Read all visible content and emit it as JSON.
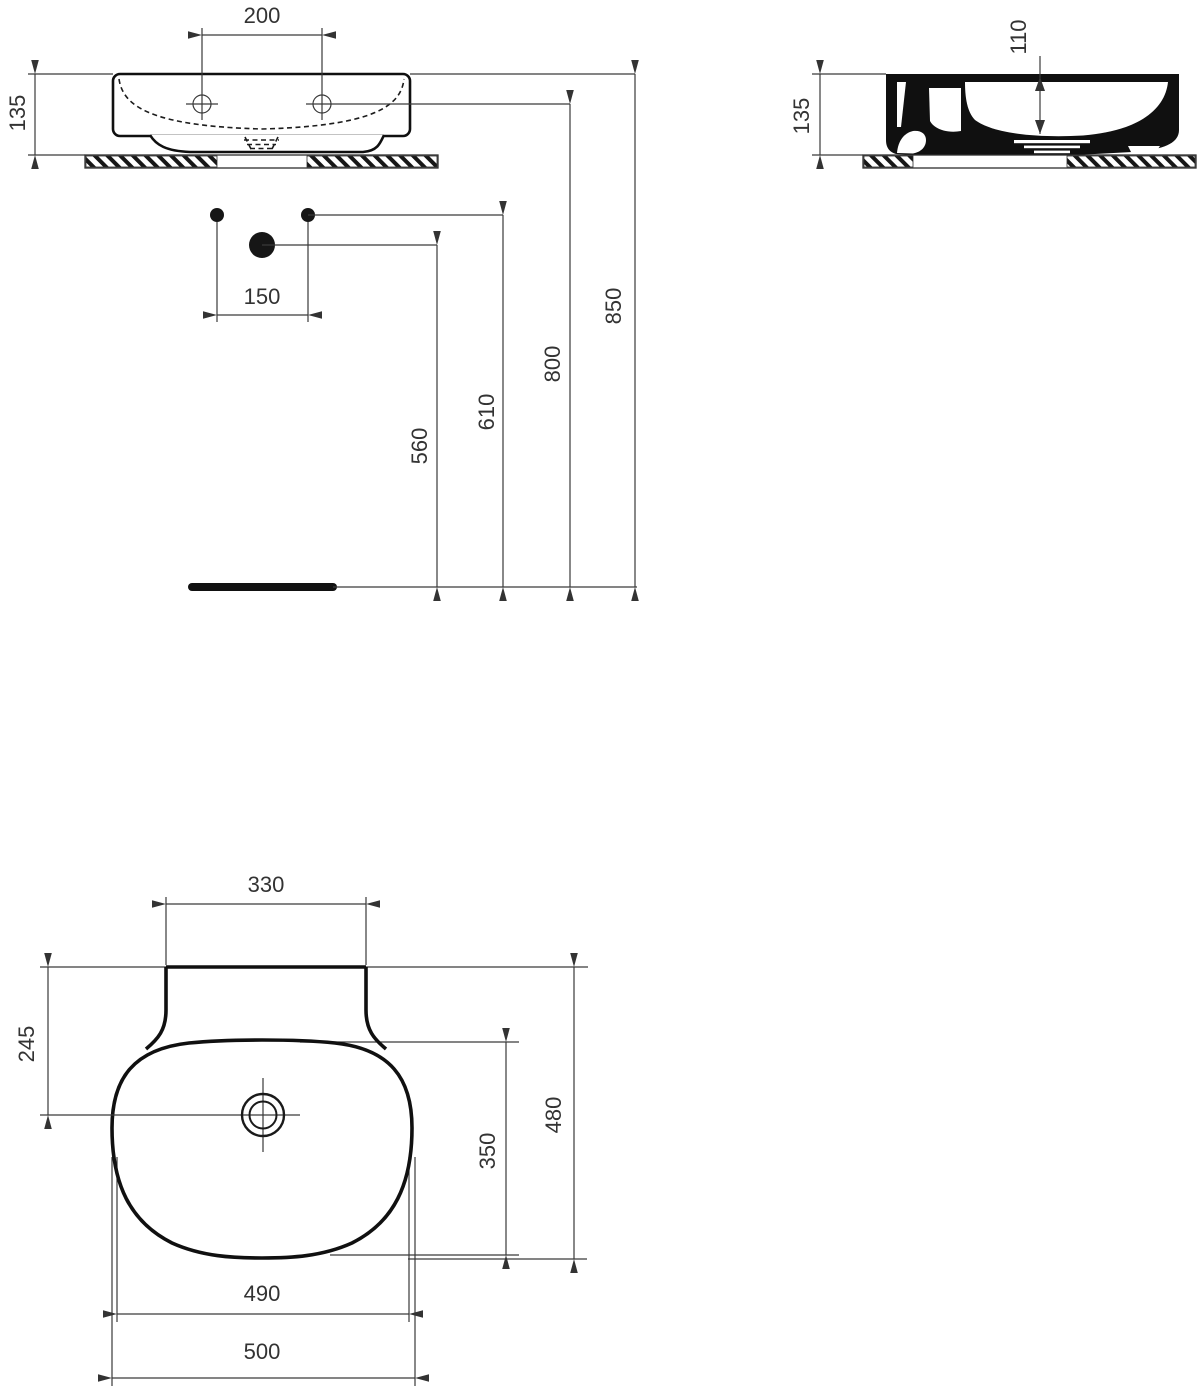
{
  "colors": {
    "line": "#3a3a3a",
    "bold_outline": "#101010",
    "text": "#333333",
    "background": "#ffffff"
  },
  "views": {
    "front": {
      "tap_hole_spacing": "200",
      "basin_height": "135",
      "hole_offset": "150",
      "drain_outlet_height": "560",
      "supply_height": "610",
      "tap_hole_height": "800",
      "rim_height": "850"
    },
    "side": {
      "basin_height": "135",
      "bowl_depth": "110"
    },
    "plan": {
      "back_edge_width": "330",
      "drain_center_from_back": "245",
      "bowl_inner_depth": "350",
      "overall_depth": "480",
      "bowl_width": "490",
      "overall_width": "500"
    }
  }
}
